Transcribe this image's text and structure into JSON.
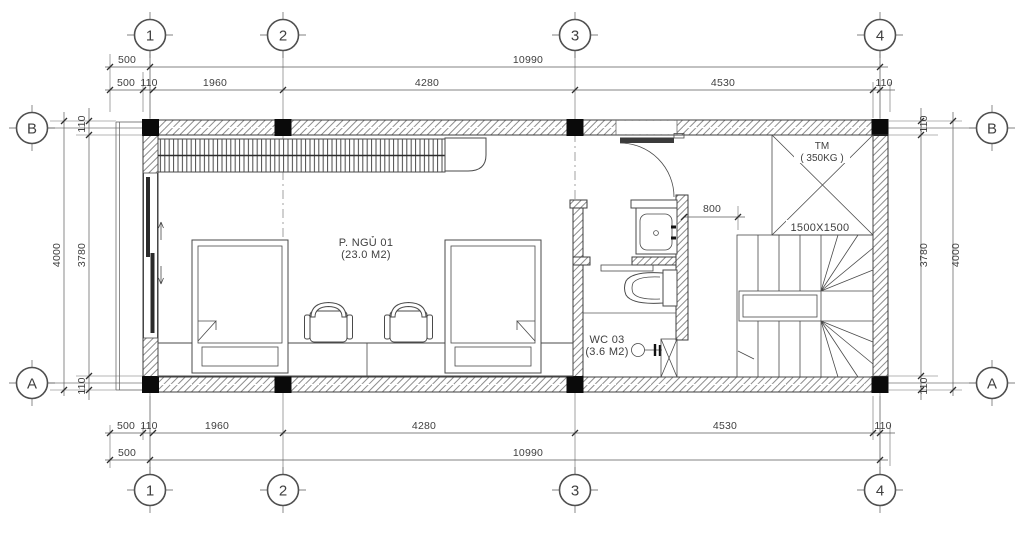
{
  "drawing_type": "architectural floor plan",
  "colors": {
    "line": "#4a4a4a",
    "wall_hatch": "#8c8c8c",
    "column_fill": "#0a0a0a",
    "background": "#ffffff"
  },
  "grid": {
    "columns": [
      "1",
      "2",
      "3",
      "4"
    ],
    "rows": [
      "B",
      "A"
    ]
  },
  "dims": {
    "top_row1": [
      "500",
      "10990"
    ],
    "top_row2": [
      "500",
      "110",
      "1960",
      "4280",
      "4530",
      "110"
    ],
    "bottom_row1": [
      "500",
      "110",
      "1960",
      "4280",
      "4530",
      "110"
    ],
    "bottom_row2": [
      "500",
      "10990"
    ],
    "left": [
      "110",
      "3780",
      "4000",
      "110"
    ],
    "right": [
      "110",
      "3780",
      "4000",
      "110"
    ],
    "wc_clearance": "800"
  },
  "rooms": {
    "bedroom": {
      "name": "P. NGỦ 01",
      "area": "(23.0 M2)"
    },
    "wc": {
      "name": "WC 03",
      "area": "(3.6 M2)"
    },
    "elevator": {
      "name": "TM",
      "capacity": "( 350KG )",
      "size": "1500X1500"
    }
  }
}
